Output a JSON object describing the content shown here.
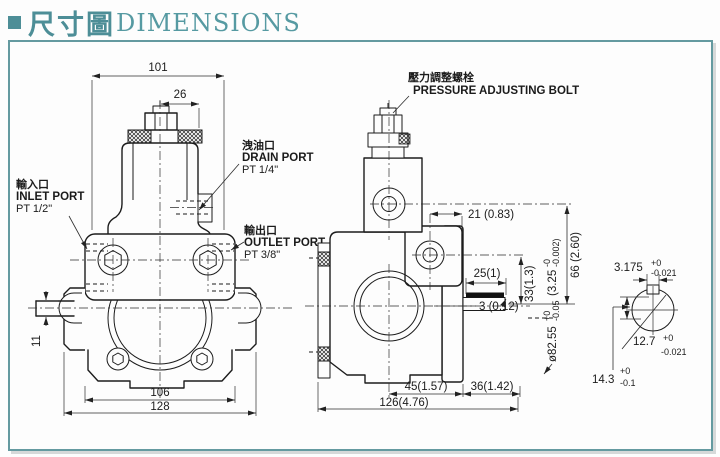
{
  "title": {
    "bullet": "■",
    "zh": "尺寸圖",
    "en": "DIMENSIONS"
  },
  "front": {
    "dim_101": "101",
    "dim_26": "26",
    "dim_11": "11",
    "dim_106": "106",
    "dim_128": "128",
    "inlet_zh": "輸入口",
    "inlet_en": "INLET PORT",
    "inlet_pt": "PT 1/2\"",
    "drain_zh": "洩油口",
    "drain_en": "DRAIN PORT",
    "drain_pt": "PT 1/4\"",
    "outlet_zh": "輸出口",
    "outlet_en": "OUTLET PORT",
    "outlet_pt": "PT 3/8\""
  },
  "side": {
    "bolt_zh": "壓力調整螺栓",
    "bolt_en": "PRESSURE ADJUSTING BOLT",
    "dim_21": "21 (0.83)",
    "dim_25": "25(1)",
    "dim_3": "3 (0.12)",
    "dim_33": "33(1.3)",
    "dim_66": "66 (2.60)",
    "dia": "ø82.55",
    "dia_plus": "+0",
    "dia_minus": "-0.05",
    "dia_in": "(3.25",
    "dia_in_plus": "-0",
    "dia_in_minus": "-0.002)",
    "dim_45": "45(1.57)",
    "dim_36": "36(1.42)",
    "dim_126": "126(4.76)"
  },
  "shaft": {
    "key_w": "3.175",
    "key_w_plus": "+0",
    "key_w_minus": "-0.021",
    "dia": "12.7",
    "dia_plus": "+0",
    "dia_minus": "-0.021",
    "height": "14.3",
    "height_plus": "+0",
    "height_minus": "-0.1"
  }
}
